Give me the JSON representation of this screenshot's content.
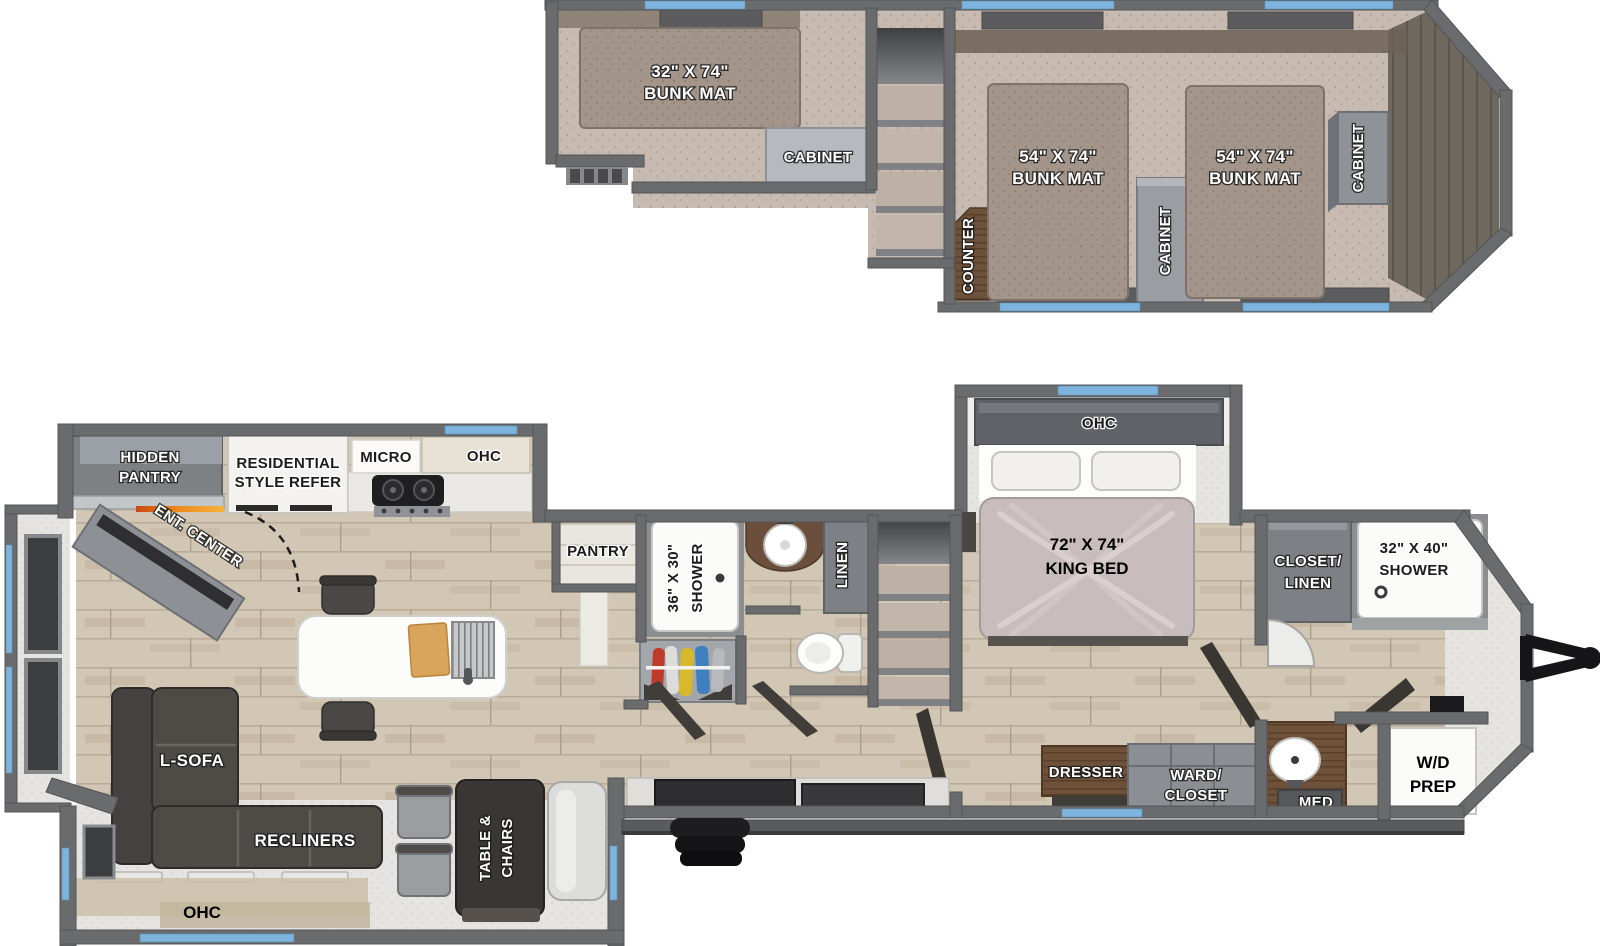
{
  "plan": {
    "loft": {
      "bunk_small_l1": "32\" X 74\"",
      "bunk_small_l2": "BUNK MAT",
      "cabinet_rear": "CABINET",
      "counter": "COUNTER",
      "bunk_left_l1": "54\" X 74\"",
      "bunk_left_l2": "BUNK MAT",
      "cabinet_mid": "CABINET",
      "bunk_right_l1": "54\" X 74\"",
      "bunk_right_l2": "BUNK MAT",
      "cabinet_front": "CABINET"
    },
    "kitchen": {
      "hidden_pantry_l1": "HIDDEN",
      "hidden_pantry_l2": "PANTRY",
      "ent_center": "ENT. CENTER",
      "refer_l1": "RESIDENTIAL",
      "refer_l2": "STYLE REFER",
      "micro": "MICRO",
      "ohc": "OHC",
      "pantry": "PANTRY"
    },
    "mid_bath": {
      "shower_l1": "36\" X 30\"",
      "shower_l2": "SHOWER",
      "linen": "LINEN"
    },
    "bedroom": {
      "ohc": "OHC",
      "bed_l1": "72\" X 74\"",
      "bed_l2": "KING BED",
      "dresser": "DRESSER",
      "ward_l1": "WARD/",
      "ward_l2": "CLOSET"
    },
    "front_bath": {
      "closet_l1": "CLOSET/",
      "closet_l2": "LINEN",
      "shower_l1": "32\" X 40\"",
      "shower_l2": "SHOWER",
      "wd_l1": "W/D",
      "wd_l2": "PREP",
      "med": "MED"
    },
    "living": {
      "lsofa": "L-SOFA",
      "recliners": "RECLINERS",
      "table_l1": "TABLE &",
      "table_l2": "CHAIRS",
      "ohc": "OHC"
    }
  },
  "colors": {
    "wall": "#6a6b6d",
    "wall_dark": "#535457",
    "window": "#7db3dc",
    "wood": "#d2c7b5",
    "carpet": "#c7bab0",
    "mat": "#a3958a",
    "speckle": "#e5e4e1",
    "sofa": "#4e4a45",
    "cabinet_gray": "#8b8e92",
    "wood_dark": "#6e5139",
    "fireplace_orange": "#e2761f"
  }
}
